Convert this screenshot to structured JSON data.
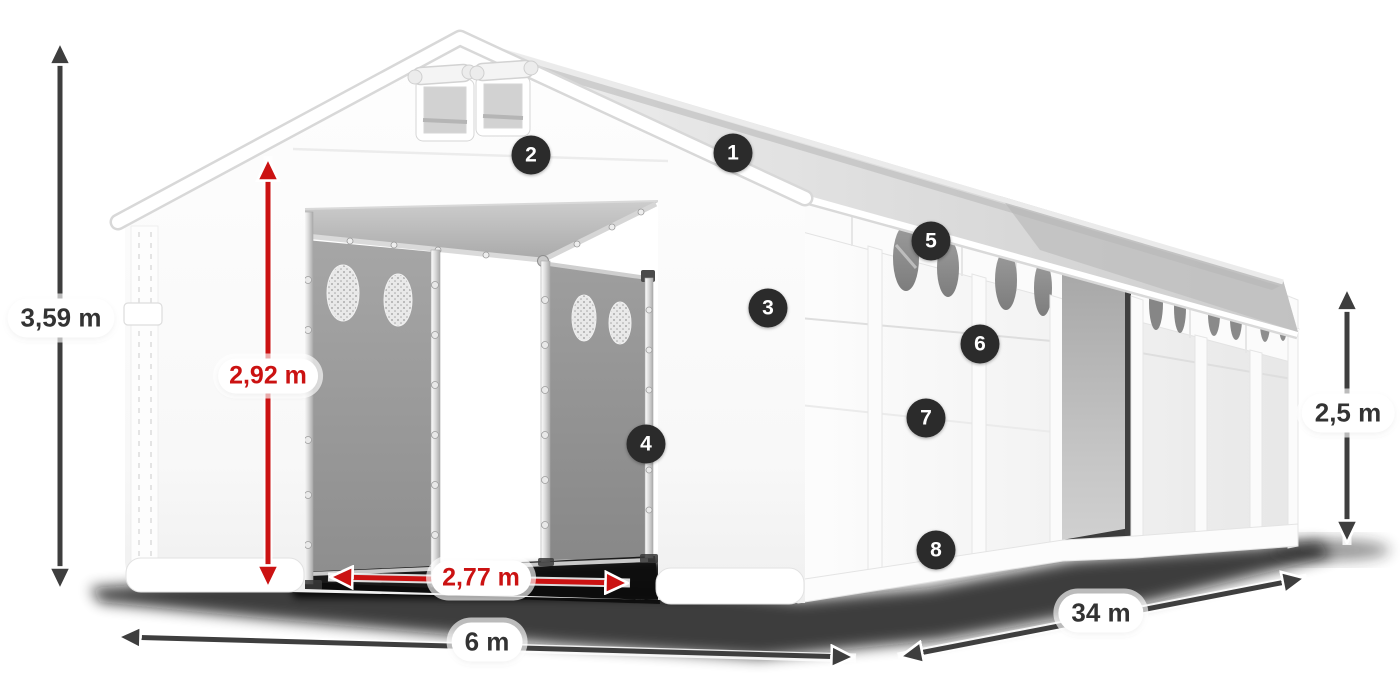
{
  "diagram": {
    "dimensions": {
      "total_height": "3,59 m",
      "door_height": "2,92 m",
      "door_width": "2,77 m",
      "front_width": "6 m",
      "side_length": "34 m",
      "side_height": "2,5 m"
    },
    "markers": [
      {
        "number": "1"
      },
      {
        "number": "2"
      },
      {
        "number": "3"
      },
      {
        "number": "4"
      },
      {
        "number": "5"
      },
      {
        "number": "6"
      },
      {
        "number": "7"
      },
      {
        "number": "8"
      }
    ],
    "colors": {
      "accent_red": "#cb1212",
      "arrow_gray": "#3e3e3e",
      "badge_bg": "#2b2b2b",
      "label_text": "#333333"
    }
  }
}
